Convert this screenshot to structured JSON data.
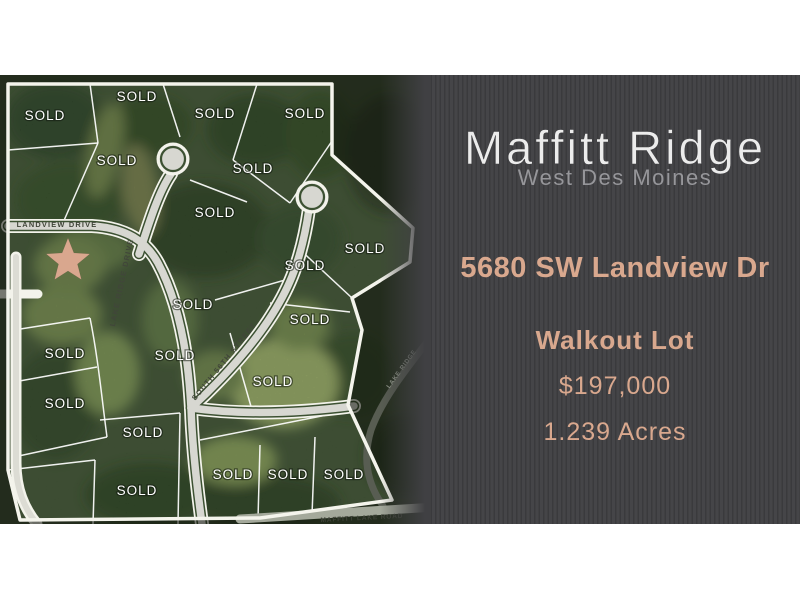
{
  "panel": {
    "title": "Maffitt Ridge",
    "subtitle": "West Des Moines",
    "address": "5680 SW Landview Dr",
    "lot_type": "Walkout Lot",
    "price": "$197,000",
    "acreage": "1.239 Acres",
    "background_color": "#404043",
    "title_color": "#ececec",
    "subtitle_color": "#96969a",
    "accent_color": "#d9a88e"
  },
  "map": {
    "sold_label": "SOLD",
    "sold_lots": [
      [
        45,
        45
      ],
      [
        137,
        26
      ],
      [
        215,
        43
      ],
      [
        305,
        43
      ],
      [
        117,
        90
      ],
      [
        253,
        98
      ],
      [
        215,
        142
      ],
      [
        305,
        195
      ],
      [
        365,
        178
      ],
      [
        193,
        234
      ],
      [
        310,
        249
      ],
      [
        65,
        283
      ],
      [
        175,
        285
      ],
      [
        273,
        311
      ],
      [
        65,
        333
      ],
      [
        143,
        362
      ],
      [
        233,
        404
      ],
      [
        288,
        404
      ],
      [
        344,
        404
      ],
      [
        137,
        420
      ]
    ],
    "streets": [
      {
        "label": "LANDVIEW DRIVE",
        "x": 57,
        "y": 152,
        "rotate": 0,
        "kind": "street-main"
      },
      {
        "label": "LAKE RIDGE DRIVE",
        "x": 124,
        "y": 208,
        "rotate": -78,
        "kind": "street-main"
      },
      {
        "label": "SOUTH 56TH STREET",
        "x": 226,
        "y": 288,
        "rotate": -51,
        "kind": "street-main"
      },
      {
        "label": "MAFFITT LAKE ROAD",
        "x": 362,
        "y": 445,
        "rotate": -3,
        "kind": "street-road"
      },
      {
        "label": "LAKE RIDGE",
        "x": 403,
        "y": 295,
        "rotate": -54,
        "kind": "street-dark"
      }
    ],
    "star": {
      "x": 68,
      "y": 186,
      "color": "#d9a78e"
    }
  }
}
